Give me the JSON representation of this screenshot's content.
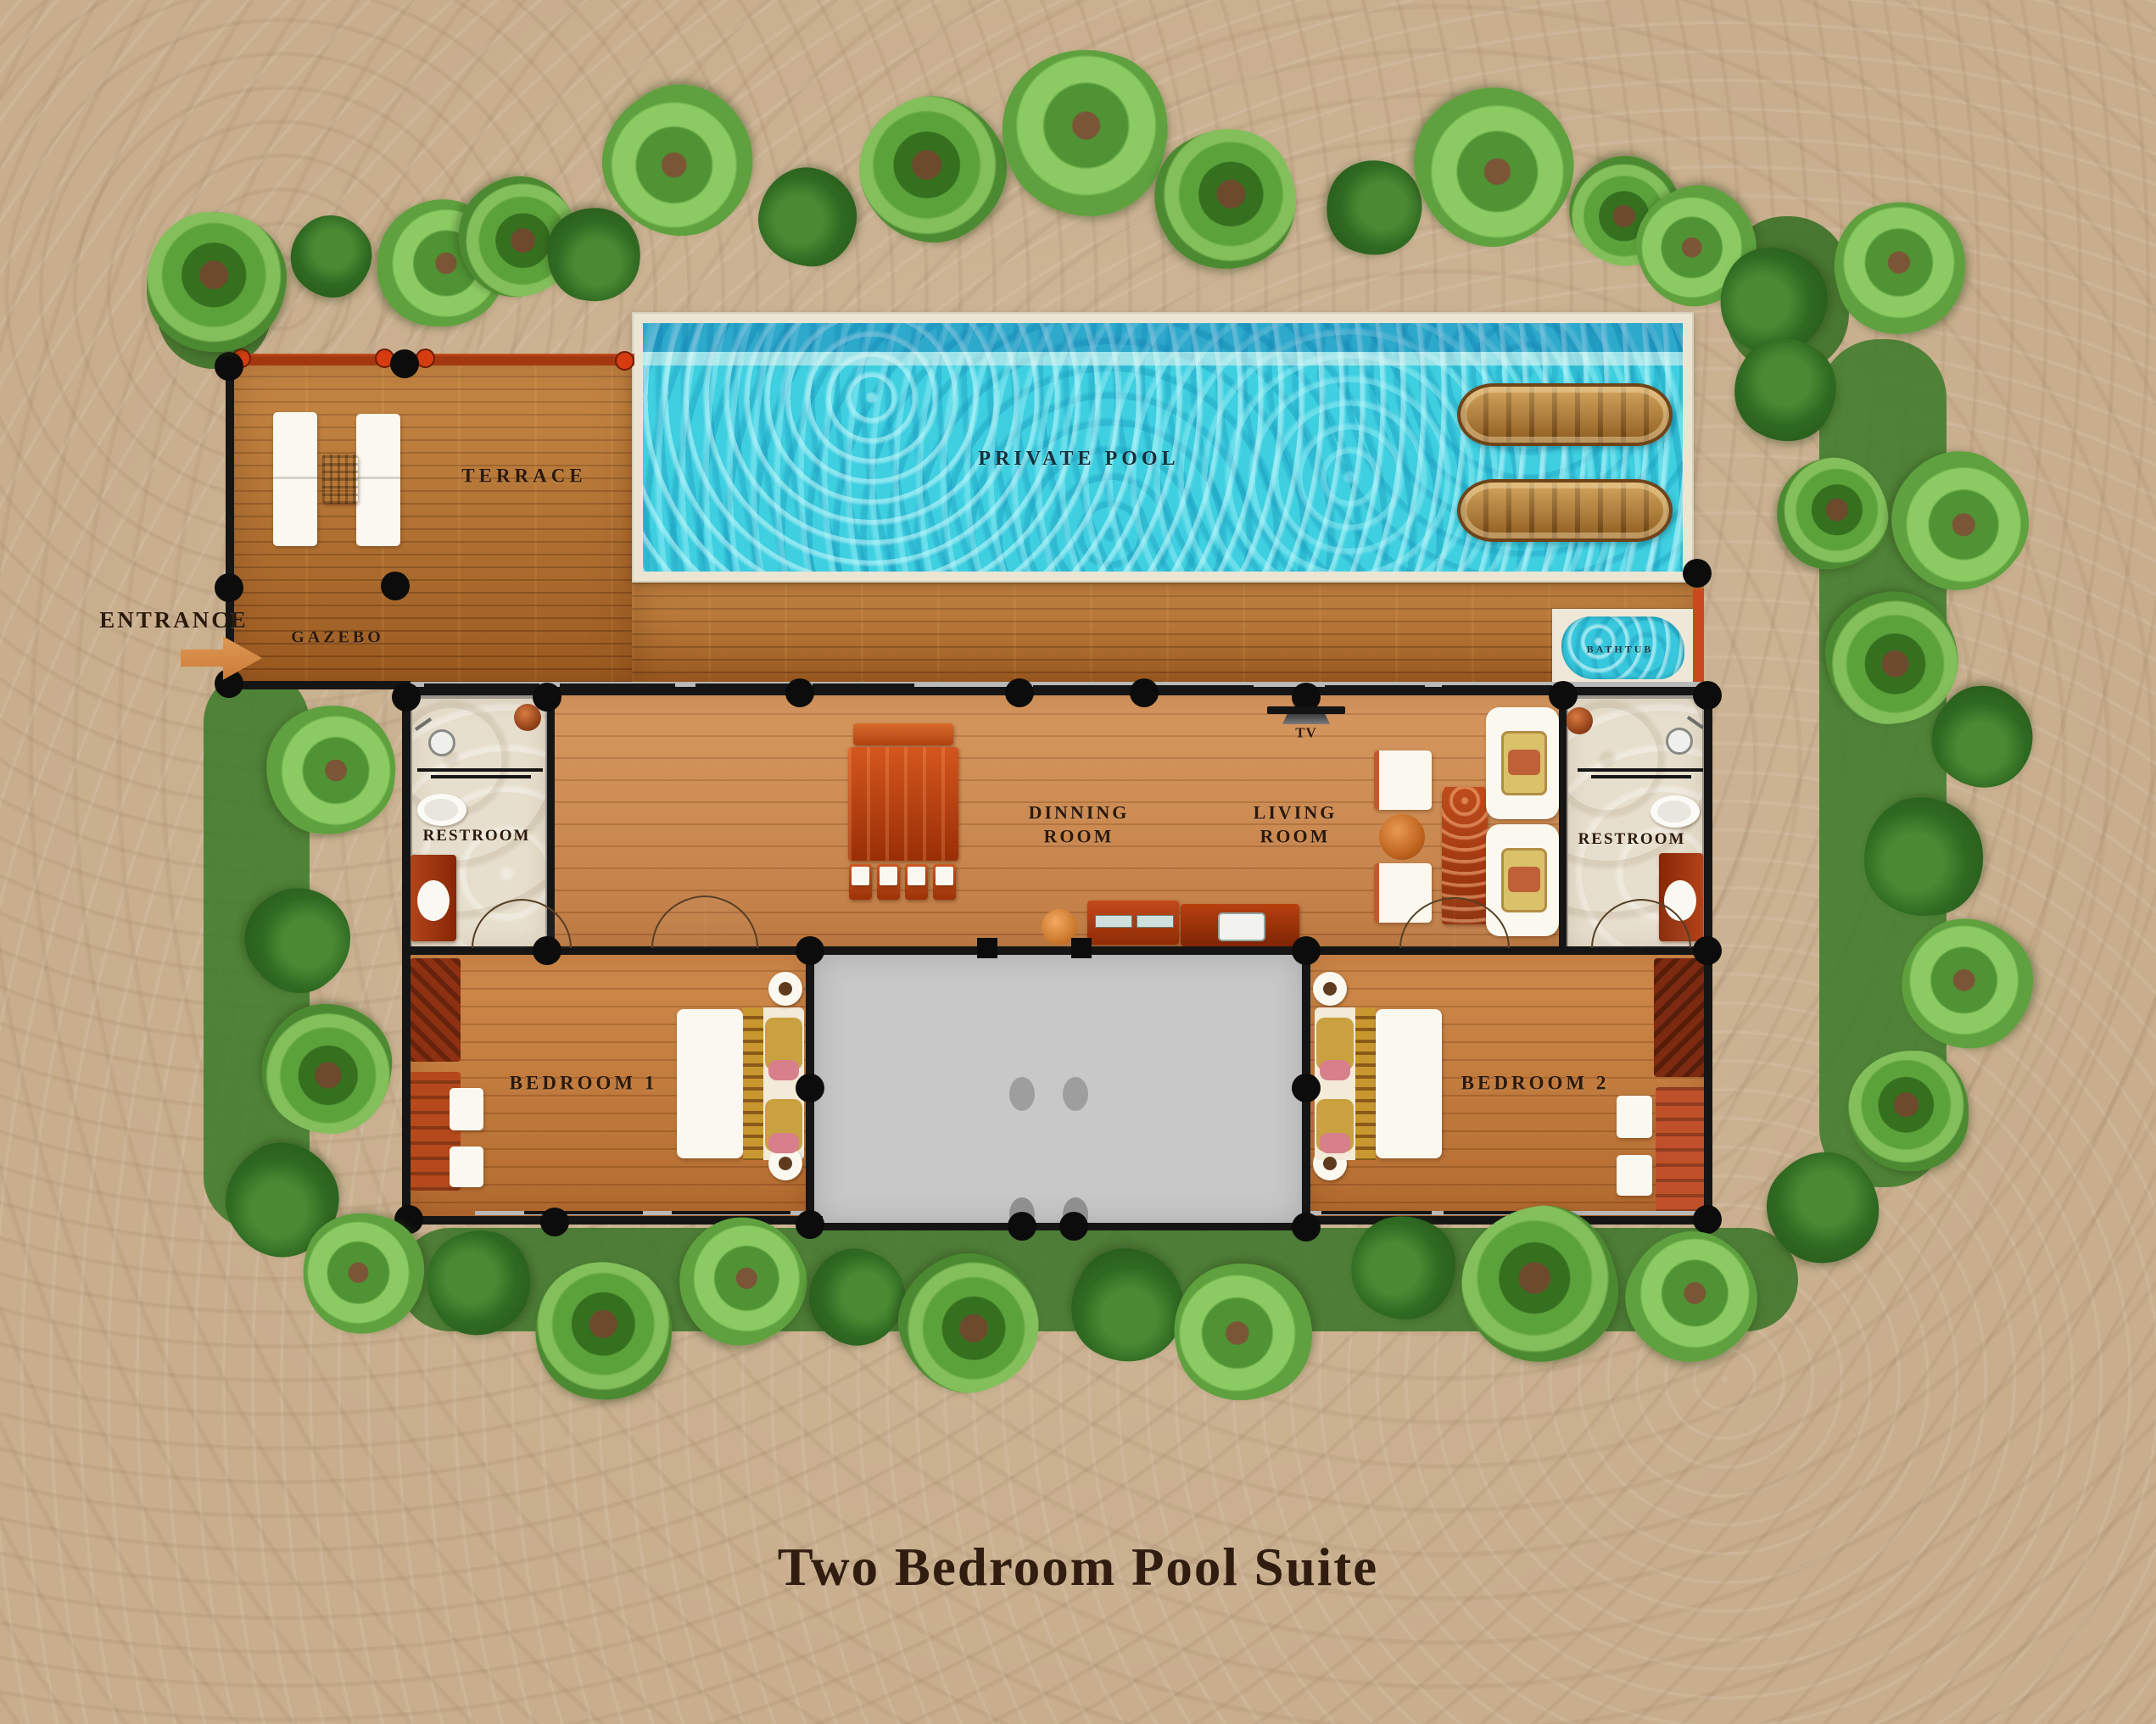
{
  "title": "Two Bedroom Pool Suite",
  "labels": {
    "entrance": "ENTRANCE",
    "gazebo": "GAZEBO",
    "terrace": "TERRACE",
    "private_pool": "PRIVATE POOL",
    "bathtub": "BATHTUB",
    "restroom_left": "RESTROOM",
    "restroom_right": "RESTROOM",
    "dining_room": "DINNING ROOM",
    "living_room": "LIVING ROOM",
    "tv": "TV",
    "bedroom_1": "BEDROOM 1",
    "bedroom_2": "BEDROOM 2"
  },
  "colors": {
    "sand": "#c8ae8d",
    "deck_wood": "#b06a28",
    "interior_wood": "#ce8a50",
    "pool_water": "#3ecfe0",
    "pool_border": "#ece5d4",
    "patio_gray": "#c8c8c8",
    "wall_black": "#151515",
    "accent_red": "#a33810",
    "tree_green": "#4c8a31",
    "text_brown": "#2b190d"
  }
}
